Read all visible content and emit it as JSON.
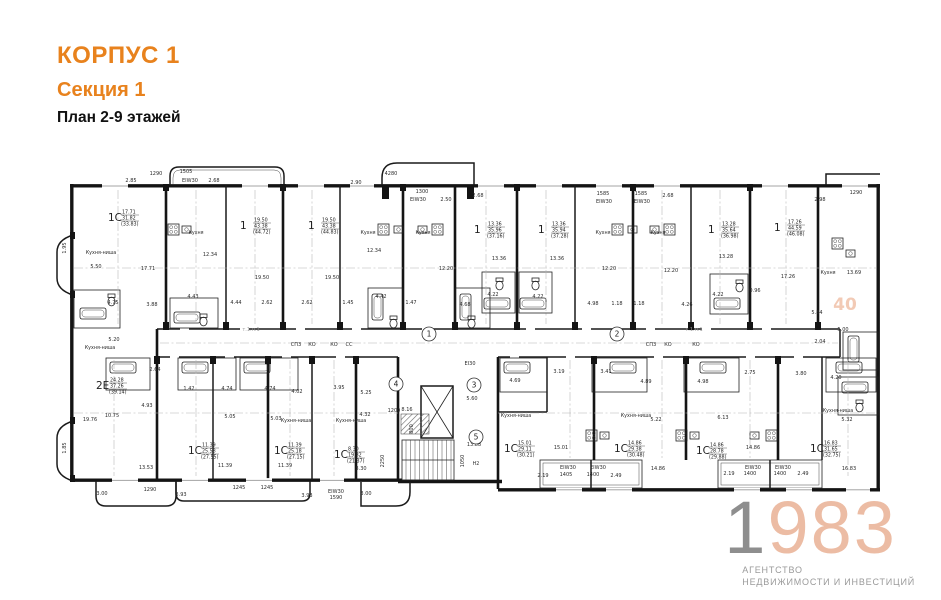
{
  "header": {
    "building": "КОРПУС 1",
    "section": "Секция 1",
    "plan": "План 2-9 этажей"
  },
  "logo": {
    "year_first": "1",
    "year_rest": "983",
    "tagline_line1": "АГЕНТСТВО",
    "tagline_line2": "НЕДВИЖИМОСТИ И ИНВЕСТИЦИЙ"
  },
  "colors": {
    "accent_orange": "#e8821d",
    "logo_gray": "#8e8e8e",
    "logo_peach": "#ecbca4",
    "plan_line": "#141414"
  },
  "plan": {
    "watermark": "40",
    "apartments": [
      {
        "type": "1С",
        "room": "17.71",
        "living": "31.82",
        "total": "(33.83)",
        "x": 58,
        "y": 64
      },
      {
        "type": "1",
        "room": "19.50",
        "living": "43.38",
        "total": "(44.72)",
        "x": 190,
        "y": 72
      },
      {
        "type": "1",
        "room": "19.50",
        "living": "43.38",
        "total": "(44.83)",
        "x": 258,
        "y": 72
      },
      {
        "type": "1",
        "room": "13.36",
        "living": "35.96",
        "total": "(37.16)",
        "x": 424,
        "y": 76
      },
      {
        "type": "1",
        "room": "13.36",
        "living": "35.94",
        "total": "(37.28)",
        "x": 488,
        "y": 76
      },
      {
        "type": "1",
        "room": "13.28",
        "living": "35.64",
        "total": "(36.98)",
        "x": 658,
        "y": 76
      },
      {
        "type": "1",
        "room": "17.26",
        "living": "44.59",
        "total": "(46.08)",
        "x": 724,
        "y": 74
      },
      {
        "type": "2Е",
        "room": "24.28",
        "living": "37.26",
        "total": "(39.14)",
        "x": 46,
        "y": 232
      },
      {
        "type": "1С",
        "room": "11.39",
        "living": "25.58",
        "total": "(27.55)",
        "x": 138,
        "y": 297
      },
      {
        "type": "1С",
        "room": "11.39",
        "living": "25.18",
        "total": "(27.15)",
        "x": 224,
        "y": 297
      },
      {
        "type": "1С",
        "room": "8.30",
        "living": "19.82",
        "total": "(21.37)",
        "x": 284,
        "y": 301
      },
      {
        "type": "1С",
        "room": "15.01",
        "living": "29.11",
        "total": "(30.21)",
        "x": 454,
        "y": 295
      },
      {
        "type": "1С",
        "room": "14.86",
        "living": "29.38",
        "total": "(30.48)",
        "x": 564,
        "y": 295
      },
      {
        "type": "1С",
        "room": "14.86",
        "living": "28.78",
        "total": "(29.88)",
        "x": 646,
        "y": 297
      },
      {
        "type": "1С",
        "room": "16.83",
        "living": "31.65",
        "total": "(32.75)",
        "x": 760,
        "y": 295
      }
    ],
    "rooms": [
      {
        "t": "Кухня",
        "x": 146,
        "y": 86
      },
      {
        "t": "Кухня",
        "x": 318,
        "y": 86
      },
      {
        "t": "Кухня",
        "x": 373,
        "y": 86
      },
      {
        "t": "Кухня",
        "x": 553,
        "y": 86
      },
      {
        "t": "Кухня",
        "x": 608,
        "y": 86
      },
      {
        "t": "Кухня",
        "x": 778,
        "y": 126
      },
      {
        "t": "Кухня-ниша",
        "x": 51,
        "y": 106
      },
      {
        "t": "Кухня-ниша",
        "x": 50,
        "y": 201
      },
      {
        "t": "Кухня-ниша",
        "x": 246,
        "y": 274
      },
      {
        "t": "Кухня-ниша",
        "x": 301,
        "y": 274
      },
      {
        "t": "Кухня-ниша",
        "x": 466,
        "y": 269
      },
      {
        "t": "Кухня-ниша",
        "x": 586,
        "y": 269
      },
      {
        "t": "Кухня-ниша",
        "x": 788,
        "y": 264
      },
      {
        "t": "Н2",
        "x": 426,
        "y": 317
      }
    ],
    "dims": [
      {
        "t": "2.85",
        "x": 81,
        "y": 34
      },
      {
        "t": "1290",
        "x": 106,
        "y": 27
      },
      {
        "t": "1505",
        "x": 136,
        "y": 25
      },
      {
        "t": "ЕІW30",
        "x": 140,
        "y": 34
      },
      {
        "t": "2.68",
        "x": 164,
        "y": 34
      },
      {
        "t": "2.90",
        "x": 306,
        "y": 36
      },
      {
        "t": "4280",
        "x": 341,
        "y": 27
      },
      {
        "t": "1300",
        "x": 372,
        "y": 45
      },
      {
        "t": "ЕІW30",
        "x": 368,
        "y": 53
      },
      {
        "t": "2.50",
        "x": 396,
        "y": 53
      },
      {
        "t": "2.68",
        "x": 428,
        "y": 49
      },
      {
        "t": "1585",
        "x": 553,
        "y": 47
      },
      {
        "t": "1585",
        "x": 591,
        "y": 47
      },
      {
        "t": "ЕІW30",
        "x": 554,
        "y": 55
      },
      {
        "t": "ЕІW30",
        "x": 592,
        "y": 55
      },
      {
        "t": "2.68",
        "x": 618,
        "y": 49
      },
      {
        "t": "2.98",
        "x": 770,
        "y": 53
      },
      {
        "t": "1290",
        "x": 806,
        "y": 46
      },
      {
        "t": "5.50",
        "x": 46,
        "y": 120
      },
      {
        "t": "17.71",
        "x": 98,
        "y": 122
      },
      {
        "t": "12.34",
        "x": 160,
        "y": 108
      },
      {
        "t": "19.50",
        "x": 212,
        "y": 131
      },
      {
        "t": "19.50",
        "x": 282,
        "y": 131
      },
      {
        "t": "12.34",
        "x": 324,
        "y": 104
      },
      {
        "t": "12.20",
        "x": 396,
        "y": 122
      },
      {
        "t": "13.36",
        "x": 449,
        "y": 112
      },
      {
        "t": "13.36",
        "x": 507,
        "y": 112
      },
      {
        "t": "12.20",
        "x": 559,
        "y": 122
      },
      {
        "t": "12.20",
        "x": 621,
        "y": 124
      },
      {
        "t": "13.28",
        "x": 676,
        "y": 110
      },
      {
        "t": "17.26",
        "x": 738,
        "y": 130
      },
      {
        "t": "13.69",
        "x": 804,
        "y": 126
      },
      {
        "t": "4.75",
        "x": 63,
        "y": 156
      },
      {
        "t": "3.88",
        "x": 102,
        "y": 158
      },
      {
        "t": "4.43",
        "x": 143,
        "y": 150
      },
      {
        "t": "4.44",
        "x": 186,
        "y": 156
      },
      {
        "t": "2.62",
        "x": 217,
        "y": 156
      },
      {
        "t": "2.62",
        "x": 257,
        "y": 156
      },
      {
        "t": "1.45",
        "x": 298,
        "y": 156
      },
      {
        "t": "4.42",
        "x": 331,
        "y": 150
      },
      {
        "t": "1.47",
        "x": 361,
        "y": 156
      },
      {
        "t": "4.68",
        "x": 415,
        "y": 158
      },
      {
        "t": "4.22",
        "x": 443,
        "y": 148
      },
      {
        "t": "4.22",
        "x": 488,
        "y": 150
      },
      {
        "t": "4.98",
        "x": 543,
        "y": 157
      },
      {
        "t": "1.18",
        "x": 567,
        "y": 157
      },
      {
        "t": "1.18",
        "x": 589,
        "y": 157
      },
      {
        "t": "4.26",
        "x": 637,
        "y": 158
      },
      {
        "t": "4.22",
        "x": 668,
        "y": 148
      },
      {
        "t": "0.96",
        "x": 705,
        "y": 144
      },
      {
        "t": "5.84",
        "x": 767,
        "y": 166
      },
      {
        "t": "5.00",
        "x": 793,
        "y": 183
      },
      {
        "t": "2.04",
        "x": 770,
        "y": 195
      },
      {
        "t": "2.75",
        "x": 700,
        "y": 226
      },
      {
        "t": "3.80",
        "x": 751,
        "y": 227
      },
      {
        "t": "4.20",
        "x": 786,
        "y": 231
      },
      {
        "t": "1.95",
        "x": 16,
        "y": 100,
        "r": -90
      },
      {
        "t": "1.85",
        "x": 16,
        "y": 300,
        "r": -90
      },
      {
        "t": "5.20",
        "x": 64,
        "y": 193
      },
      {
        "t": "2.64",
        "x": 105,
        "y": 223
      },
      {
        "t": "1.42",
        "x": 139,
        "y": 242
      },
      {
        "t": "4.93",
        "x": 97,
        "y": 259
      },
      {
        "t": "10.75",
        "x": 62,
        "y": 269
      },
      {
        "t": "19.76",
        "x": 40,
        "y": 273
      },
      {
        "t": "4.74",
        "x": 177,
        "y": 242
      },
      {
        "t": "4.74",
        "x": 220,
        "y": 242
      },
      {
        "t": "5.05",
        "x": 180,
        "y": 270
      },
      {
        "t": "5.03",
        "x": 226,
        "y": 272
      },
      {
        "t": "4.02",
        "x": 247,
        "y": 245
      },
      {
        "t": "3.95",
        "x": 289,
        "y": 241
      },
      {
        "t": "5.25",
        "x": 316,
        "y": 246
      },
      {
        "t": "4.32",
        "x": 315,
        "y": 268
      },
      {
        "t": "11.39",
        "x": 175,
        "y": 319
      },
      {
        "t": "11.39",
        "x": 235,
        "y": 319
      },
      {
        "t": "8.30",
        "x": 311,
        "y": 322
      },
      {
        "t": "13.53",
        "x": 96,
        "y": 321
      },
      {
        "t": "3.00",
        "x": 52,
        "y": 347
      },
      {
        "t": "1290",
        "x": 100,
        "y": 343
      },
      {
        "t": "3.93",
        "x": 131,
        "y": 348
      },
      {
        "t": "1245",
        "x": 189,
        "y": 341
      },
      {
        "t": "1245",
        "x": 217,
        "y": 341
      },
      {
        "t": "3.93",
        "x": 257,
        "y": 349
      },
      {
        "t": "ЕІW30",
        "x": 286,
        "y": 345
      },
      {
        "t": "1590",
        "x": 286,
        "y": 351
      },
      {
        "t": "3.00",
        "x": 316,
        "y": 347
      },
      {
        "t": "1200",
        "x": 344,
        "y": 264
      },
      {
        "t": "8.16",
        "x": 357,
        "y": 263
      },
      {
        "t": "800",
        "x": 363,
        "y": 281,
        "r": -90
      },
      {
        "t": "2250",
        "x": 334,
        "y": 313,
        "r": -90
      },
      {
        "t": "1050",
        "x": 414,
        "y": 313,
        "r": -90
      },
      {
        "t": "5.60",
        "x": 422,
        "y": 252
      },
      {
        "t": "13.88",
        "x": 424,
        "y": 298
      },
      {
        "t": "ЕІ30",
        "x": 420,
        "y": 217
      },
      {
        "t": "3.19",
        "x": 509,
        "y": 225
      },
      {
        "t": "3.41",
        "x": 556,
        "y": 225
      },
      {
        "t": "4.69",
        "x": 465,
        "y": 234
      },
      {
        "t": "4.89",
        "x": 596,
        "y": 235
      },
      {
        "t": "4.98",
        "x": 653,
        "y": 235
      },
      {
        "t": "5.22",
        "x": 606,
        "y": 273
      },
      {
        "t": "6.13",
        "x": 673,
        "y": 271
      },
      {
        "t": "5.32",
        "x": 797,
        "y": 273
      },
      {
        "t": "15.01",
        "x": 511,
        "y": 301
      },
      {
        "t": "14.86",
        "x": 608,
        "y": 322
      },
      {
        "t": "14.86",
        "x": 703,
        "y": 301
      },
      {
        "t": "16.83",
        "x": 799,
        "y": 322
      },
      {
        "t": "2.19",
        "x": 493,
        "y": 329
      },
      {
        "t": "1405",
        "x": 516,
        "y": 328
      },
      {
        "t": "1400",
        "x": 543,
        "y": 328
      },
      {
        "t": "2.49",
        "x": 566,
        "y": 329
      },
      {
        "t": "ЕІW30",
        "x": 518,
        "y": 321
      },
      {
        "t": "ЕІW30",
        "x": 548,
        "y": 321
      },
      {
        "t": "2.19",
        "x": 679,
        "y": 327
      },
      {
        "t": "1400",
        "x": 700,
        "y": 327
      },
      {
        "t": "1400",
        "x": 730,
        "y": 327
      },
      {
        "t": "2.49",
        "x": 753,
        "y": 327
      },
      {
        "t": "ЕІW30",
        "x": 703,
        "y": 321
      },
      {
        "t": "ЕІW30",
        "x": 733,
        "y": 321
      },
      {
        "t": "СПЗ",
        "x": 246,
        "y": 198
      },
      {
        "t": "КО",
        "x": 262,
        "y": 198
      },
      {
        "t": "КО",
        "x": 284,
        "y": 198
      },
      {
        "t": "СС",
        "x": 299,
        "y": 198
      },
      {
        "t": "СПЗ",
        "x": 601,
        "y": 198
      },
      {
        "t": "КО",
        "x": 618,
        "y": 198
      },
      {
        "t": "КО",
        "x": 646,
        "y": 198
      },
      {
        "t": "т.1.п.1",
        "x": 201,
        "y": 183,
        "g": 1
      },
      {
        "t": "т.1.п.1",
        "x": 644,
        "y": 183,
        "g": 1
      }
    ],
    "axes": [
      {
        "n": "1",
        "x": 379,
        "y": 186
      },
      {
        "n": "2",
        "x": 567,
        "y": 186
      },
      {
        "n": "3",
        "x": 424,
        "y": 237
      },
      {
        "n": "4",
        "x": 346,
        "y": 236
      },
      {
        "n": "5",
        "x": 426,
        "y": 289
      }
    ]
  }
}
